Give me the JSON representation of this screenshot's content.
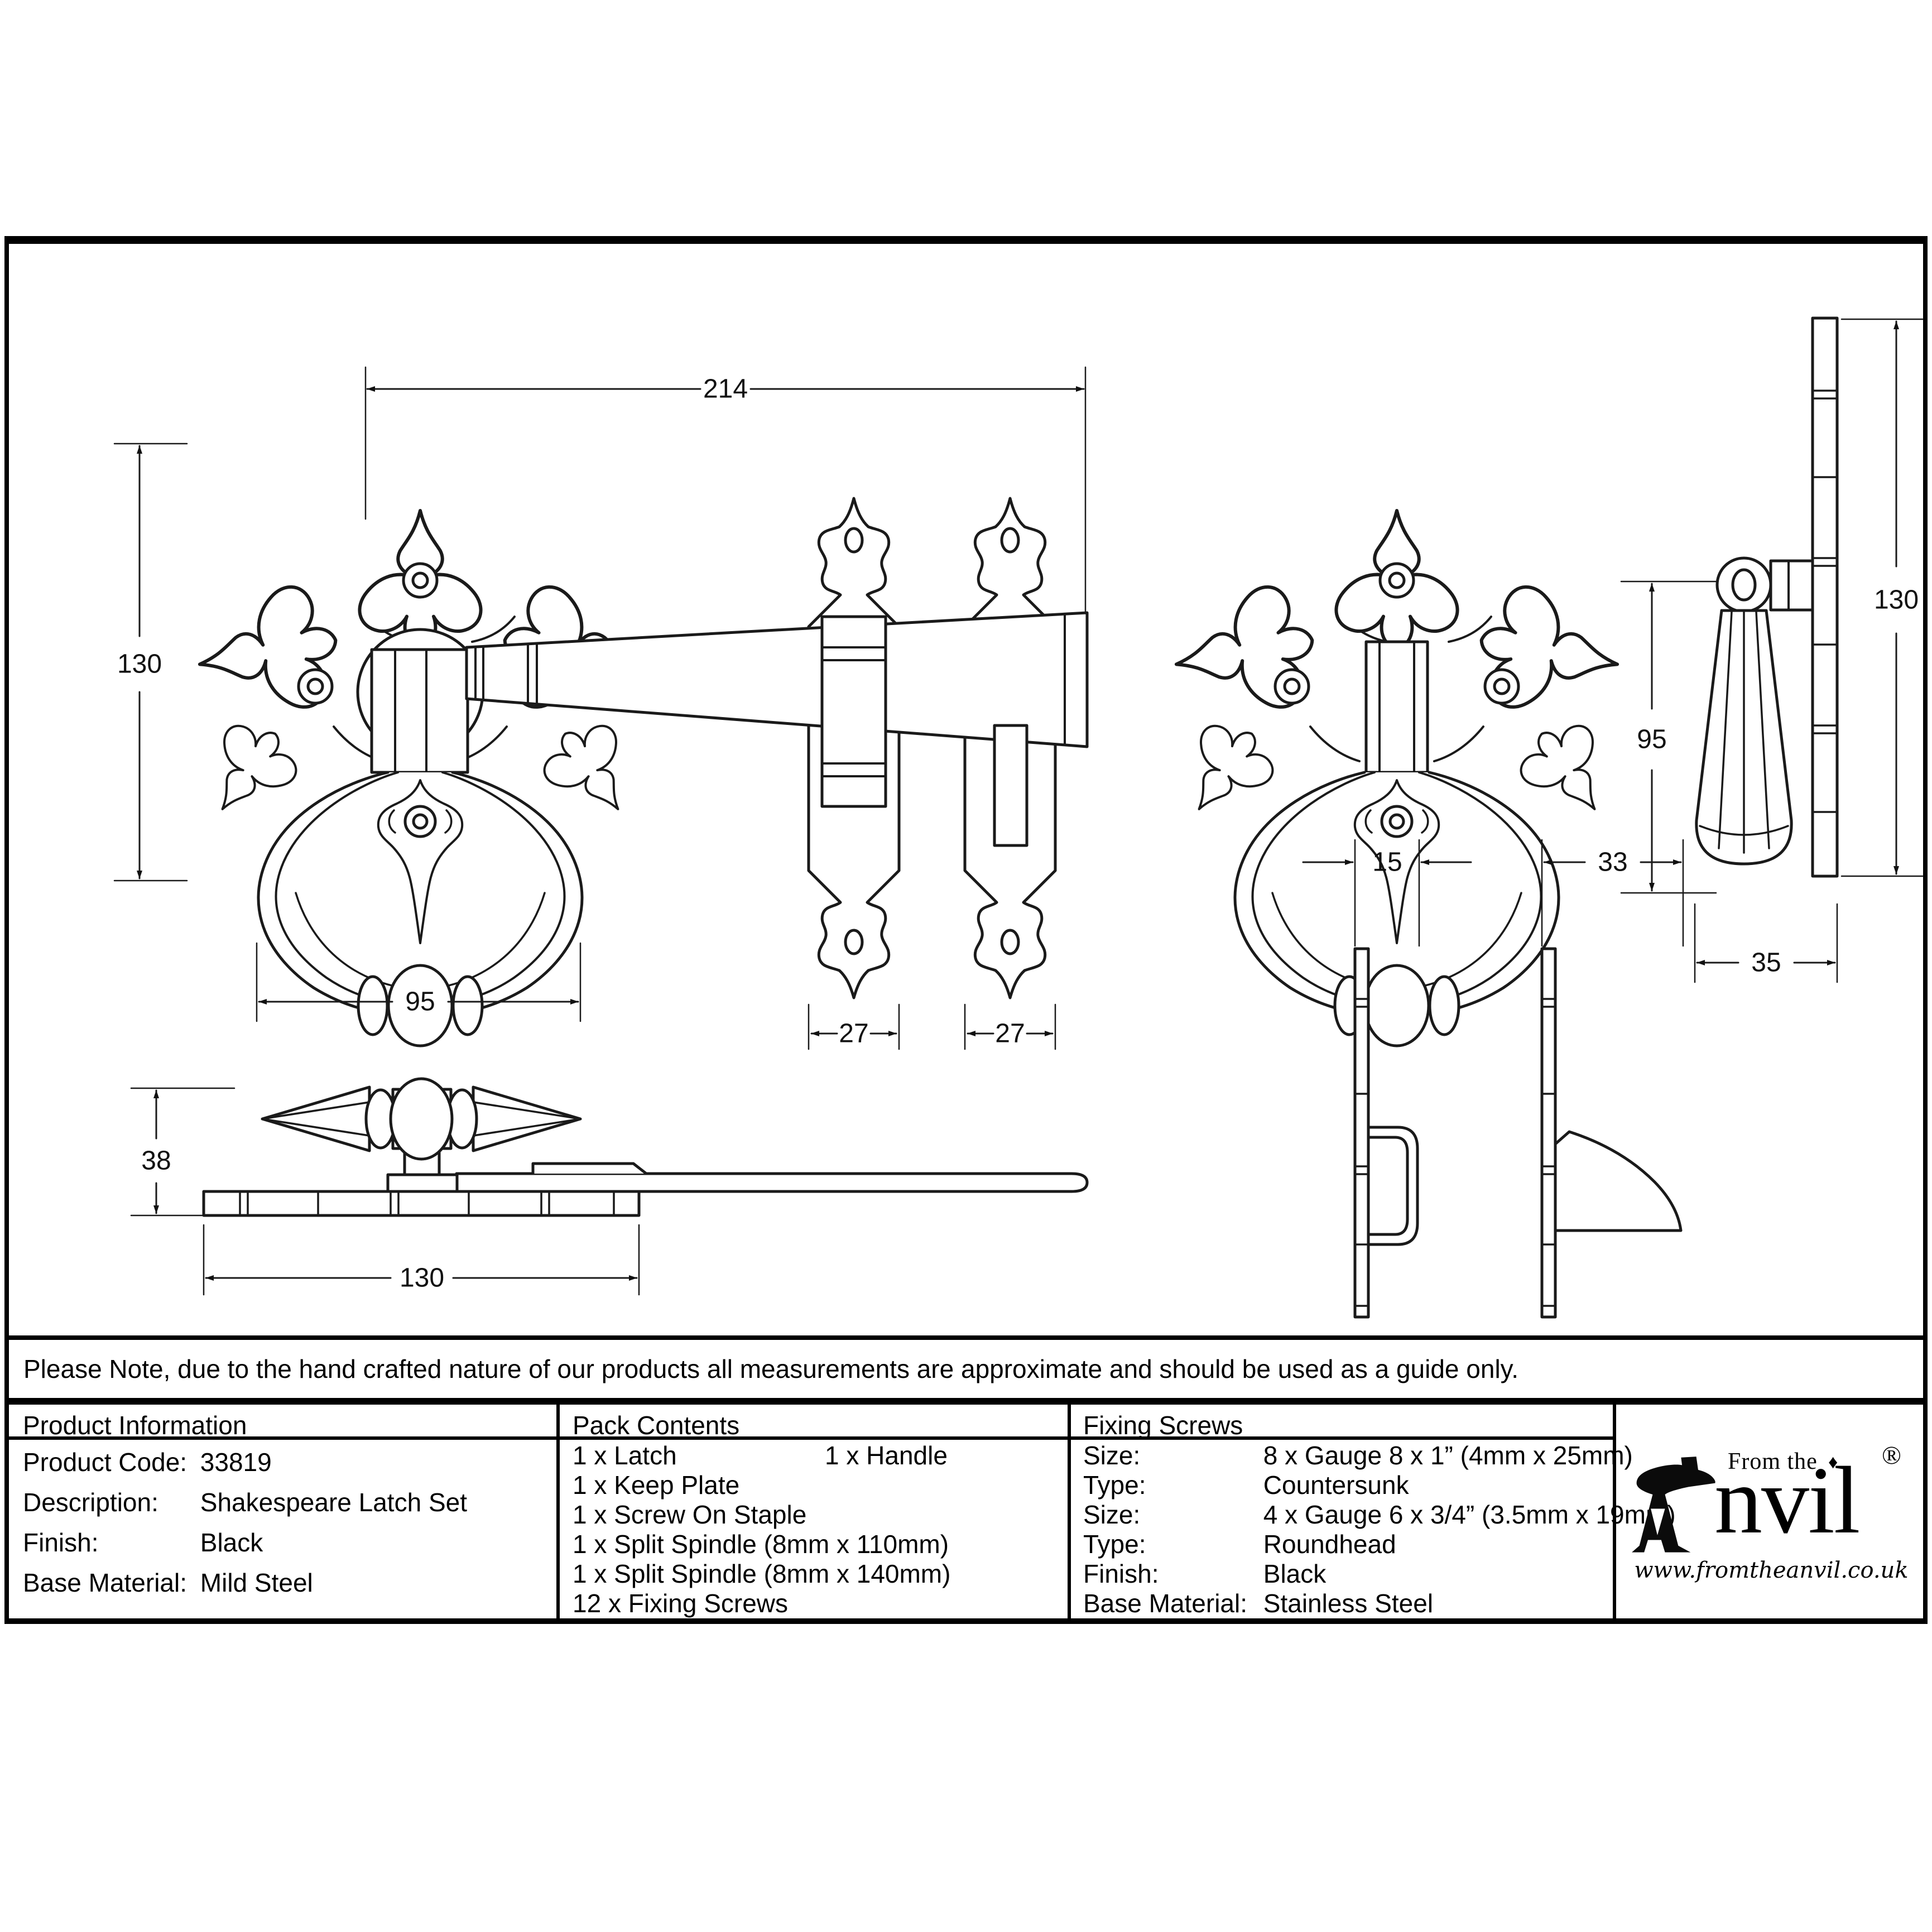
{
  "note": "Please Note, due to the hand crafted nature of our products all measurements are approximate and should be used as a guide only.",
  "product_information": {
    "title": "Product Information",
    "rows": [
      {
        "label": "Product Code:",
        "value": "33819"
      },
      {
        "label": "Description:",
        "value": "Shakespeare Latch Set"
      },
      {
        "label": "Finish:",
        "value": "Black"
      },
      {
        "label": "Base Material:",
        "value": "Mild Steel"
      }
    ]
  },
  "pack_contents": {
    "title": "Pack Contents",
    "items_col1": [
      "1 x Latch",
      "1 x Keep Plate",
      "1 x Screw On Staple",
      "1 x Split Spindle (8mm x 110mm)",
      "1 x Split Spindle (8mm x 140mm)",
      "12 x Fixing Screws"
    ],
    "items_col2": [
      "1 x Handle"
    ]
  },
  "fixing_screws": {
    "title": "Fixing Screws",
    "rows": [
      {
        "label": "Size:",
        "value": "8 x Gauge 8 x 1” (4mm x 25mm)"
      },
      {
        "label": "Type:",
        "value": "Countersunk"
      },
      {
        "label": "Size:",
        "value": "4 x Gauge 6 x 3/4” (3.5mm x 19mm)"
      },
      {
        "label": "Type:",
        "value": "Roundhead"
      },
      {
        "label": "Finish:",
        "value": "Black"
      },
      {
        "label": "Base Material:",
        "value": "Stainless Steel"
      }
    ]
  },
  "logo": {
    "from_the": "From the",
    "diamond": "♦",
    "anvil_rest": "nvil",
    "registered": "®",
    "url": "www.fromtheanvil.co.uk"
  },
  "dimensions": {
    "front_width": "214",
    "plate_height": "130",
    "ring_width": "95",
    "keep_width_a": "27",
    "keep_width_b": "27",
    "side_height": "38",
    "plate_length": "130",
    "handle_drop": "95",
    "handle_plate_height": "130",
    "staple_depth": "15",
    "keeper_depth": "33",
    "handle_depth": "35"
  }
}
